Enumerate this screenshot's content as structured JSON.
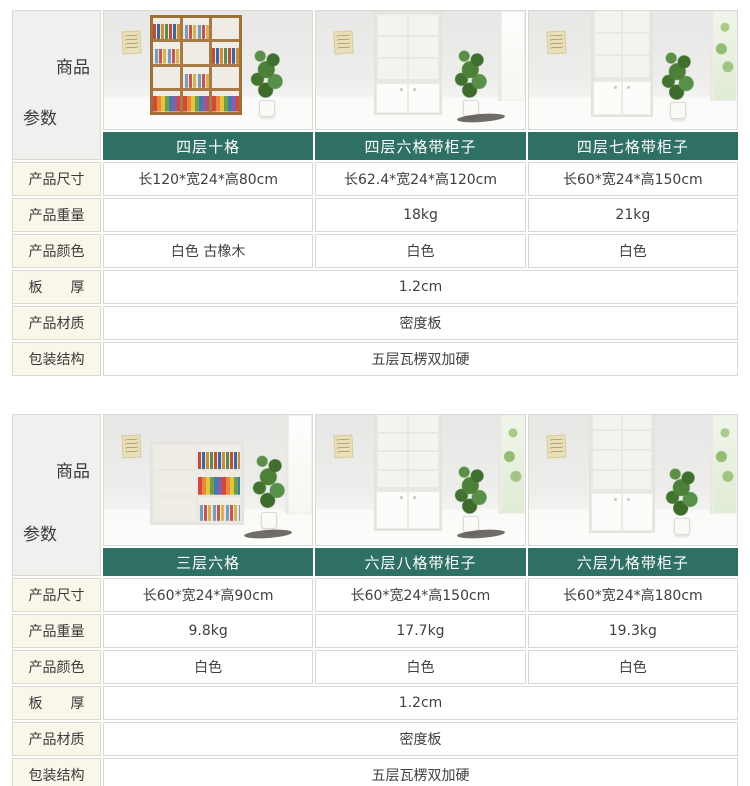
{
  "colors": {
    "banner_bg": "#2e7164",
    "banner_text": "#ffffff",
    "label_bg": "#faf6e9",
    "cell_border": "#d9d8d2",
    "text": "#3f3f3f"
  },
  "header_cell": {
    "top_label": "商品",
    "bottom_label": "参数"
  },
  "row_labels": [
    "产品尺寸",
    "产品重量",
    "产品颜色",
    "板　　厚",
    "产品材质",
    "包装结构"
  ],
  "sections": [
    {
      "products": [
        {
          "name": "四层十格",
          "size": "长120*宽24*高80cm",
          "weight": "",
          "color": "白色 古橡木"
        },
        {
          "name": "四层六格带柜子",
          "size": "长62.4*宽24*高120cm",
          "weight": "18kg",
          "color": "白色"
        },
        {
          "name": "四层七格带柜子",
          "size": "长60*宽24*高150cm",
          "weight": "21kg",
          "color": "白色"
        }
      ],
      "board_thickness": "1.2cm",
      "material": "密度板",
      "packaging": "五层瓦楞双加硬"
    },
    {
      "products": [
        {
          "name": "三层六格",
          "size": "长60*宽24*高90cm",
          "weight": "9.8kg",
          "color": "白色"
        },
        {
          "name": "六层八格带柜子",
          "size": "长60*宽24*高150cm",
          "weight": "17.7kg",
          "color": "白色"
        },
        {
          "name": "六层九格带柜子",
          "size": "长60*宽24*高180cm",
          "weight": "19.3kg",
          "color": "白色"
        }
      ],
      "board_thickness": "1.2cm",
      "material": "密度板",
      "packaging": "五层瓦楞双加硬"
    }
  ]
}
